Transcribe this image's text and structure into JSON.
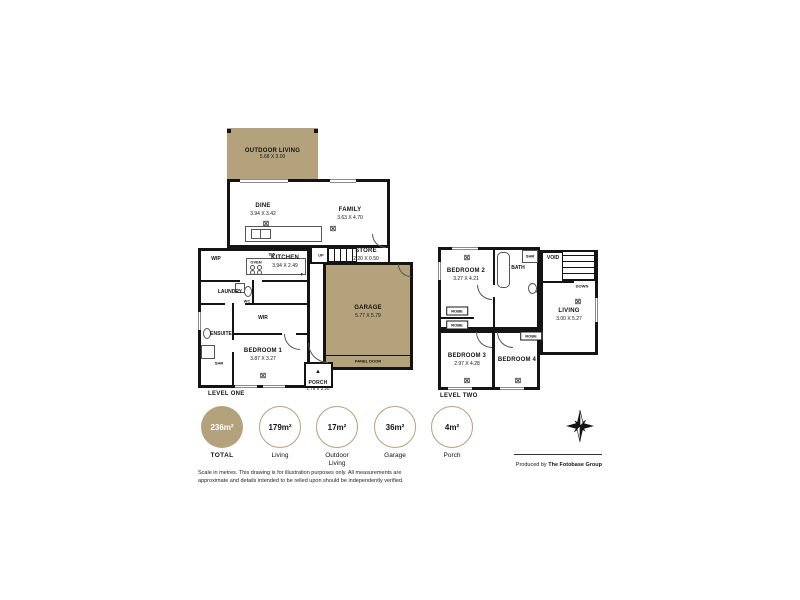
{
  "palette": {
    "tan": "#b3a27c",
    "wall": "#141414",
    "white": "#ffffff"
  },
  "symbols": {
    "light": "⊠",
    "entry": "▲"
  },
  "level_one": {
    "label": "LEVEL ONE",
    "rooms": {
      "outdoor_living": {
        "name": "OUTDOOR LIVING",
        "dims": "5.68 X 3.00"
      },
      "dine": {
        "name": "DINE",
        "dims": "3.94 X 3.42"
      },
      "family": {
        "name": "FAMILY",
        "dims": "3.63 X 4.70"
      },
      "kitchen": {
        "name": "KITCHEN",
        "dims": "3.94 X 2.49"
      },
      "store": {
        "name": "STORE",
        "dims": "2.20 X 0.50"
      },
      "garage": {
        "name": "GARAGE",
        "dims": "5.77 X 5.79"
      },
      "porch": {
        "name": "PORCH",
        "dims": "1.76 X 2.20"
      },
      "bedroom1": {
        "name": "BEDROOM 1",
        "dims": "3.87 X 3.27"
      },
      "wip": {
        "name": "WIP"
      },
      "laundry": {
        "name": "LAUNDRY"
      },
      "wc": {
        "name": "WC"
      },
      "wir": {
        "name": "WIR"
      },
      "ensuite": {
        "name": "ENSUITE"
      }
    },
    "fixtures": {
      "dw": "DW",
      "oven": "OVEN",
      "fridge": "F",
      "shr": "SHR",
      "up": "UP",
      "panel_door": "PANEL DOOR"
    }
  },
  "level_two": {
    "label": "LEVEL TWO",
    "rooms": {
      "bedroom2": {
        "name": "BEDROOM 2",
        "dims": "3.27 X 4.21"
      },
      "bedroom3": {
        "name": "BEDROOM 3",
        "dims": "2.97 X 4.28"
      },
      "bedroom4": {
        "name": "BEDROOM 4"
      },
      "living": {
        "name": "LIVING",
        "dims": "3.00 X 5.27"
      },
      "bath": {
        "name": "BATH"
      },
      "wc": {
        "name": "WC"
      },
      "void": {
        "name": "VOID"
      }
    },
    "fixtures": {
      "robe": "ROBE",
      "shr": "SHR",
      "down": "DOWN"
    }
  },
  "legend": {
    "areas": [
      {
        "value": "236m²",
        "label": "TOTAL"
      },
      {
        "value": "179m²",
        "label": "Living"
      },
      {
        "value": "17m²",
        "label": "Outdoor Living"
      },
      {
        "value": "36m²",
        "label": "Garage"
      },
      {
        "value": "4m²",
        "label": "Porch"
      }
    ]
  },
  "disclaimer": {
    "line1": "Scale in metres. This drawing is for illustration purposes only. All measurements are",
    "line2": "approximate and details intended to be relied upon should be independently verified."
  },
  "credit": {
    "prefix": "Produced by ",
    "name": "The Fotobase Group"
  }
}
